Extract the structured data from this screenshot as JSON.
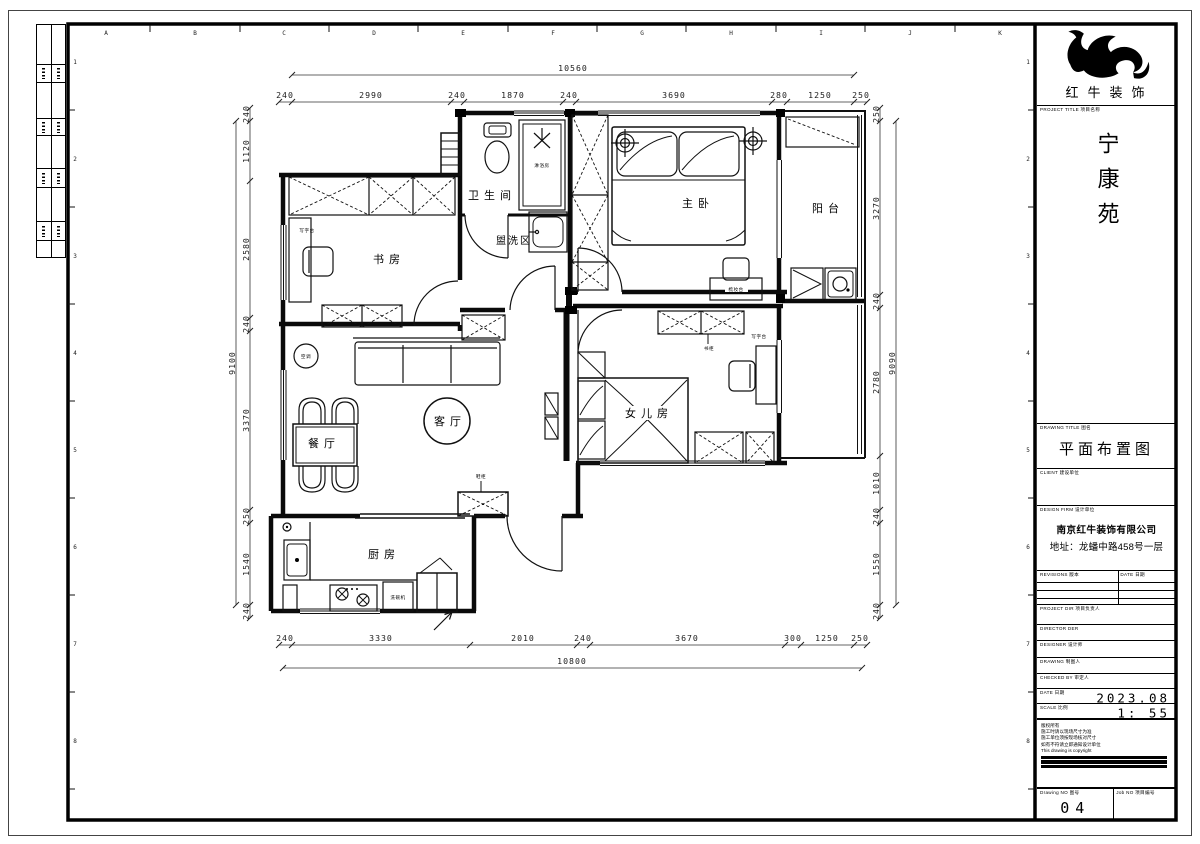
{
  "rulers": {
    "letters": [
      "A",
      "B",
      "C",
      "D",
      "E",
      "F",
      "G",
      "H",
      "I",
      "J",
      "K"
    ],
    "numbers": [
      "1",
      "2",
      "3",
      "4",
      "5",
      "6",
      "7",
      "8"
    ]
  },
  "plan": {
    "rooms": {
      "bathroom": "卫生间",
      "shower": "淋浴房",
      "wash_area": "盥洗区",
      "master_bedroom": "主卧",
      "balcony": "阳台",
      "study": "书房",
      "living_room": "客厅",
      "dining_room": "餐厅",
      "daughter_room": "女儿房",
      "kitchen": "厨房"
    },
    "furniture": {
      "desk_study": "写字台",
      "desk_daughter": "写字台",
      "ac": "空调",
      "bookcase": "书柜",
      "shoe_cabinet": "鞋柜",
      "dishwasher": "洗碗机",
      "dresser": "梳妆台"
    },
    "dims": {
      "top_total": "10560",
      "top": [
        "240",
        "2990",
        "240",
        "1870",
        "240",
        "3690",
        "280",
        "1250",
        "250"
      ],
      "bottom_total": "10800",
      "bottom": [
        "240",
        "3330",
        "2010",
        "240",
        "3670",
        "300",
        "1250",
        "250"
      ],
      "left_total": "9100",
      "left": [
        "240",
        "1120",
        "2580",
        "240",
        "3370",
        "250",
        "1540",
        "240"
      ],
      "right_total": "9090",
      "right": [
        "250",
        "3270",
        "240",
        "2780",
        "1010",
        "240",
        "1550",
        "240"
      ]
    }
  },
  "titleblock": {
    "brand": "红牛装饰",
    "project_title_label": "PROJECT TITLE 项目名称",
    "project_name": "宁康苑",
    "drawing_title_label": "DRAWING TITLE 图名",
    "drawing_title": "平面布置图",
    "client_label": "CLIENT 建设单位",
    "design_firm_label": "DESIGN FIRM 设计单位",
    "design_firm_name": "南京红牛装饰有限公司",
    "design_firm_address": "地址：龙蟠中路458号一层",
    "revisions_label": "REVISIONS 版本",
    "date_col_label": "DATE 日期",
    "project_dir_label": "PROJECT DIR 项目负责人",
    "director_label": "DIRECTOR DER",
    "designer_label": "DESIGNER 设计师",
    "drawing_label": "DRAWING 制图人",
    "checked_label": "CHECKED BY 审定人",
    "date_label": "DATE 日期",
    "date_value": "2023.08",
    "scale_label": "SCALE 比例",
    "scale_value": "1:  55",
    "copyright_lines": {
      "l1": "版权所有",
      "l2": "施工时请以现场尺寸为准",
      "l3": "施工单位须按现场核对尺寸",
      "l4": "如有不符请立即通知设计单位",
      "l5": "This drawing is copyright"
    },
    "drawing_no_label": "Drawing NO 图号",
    "drawing_no": "04",
    "job_no_label": "Job NO 项目编号"
  }
}
